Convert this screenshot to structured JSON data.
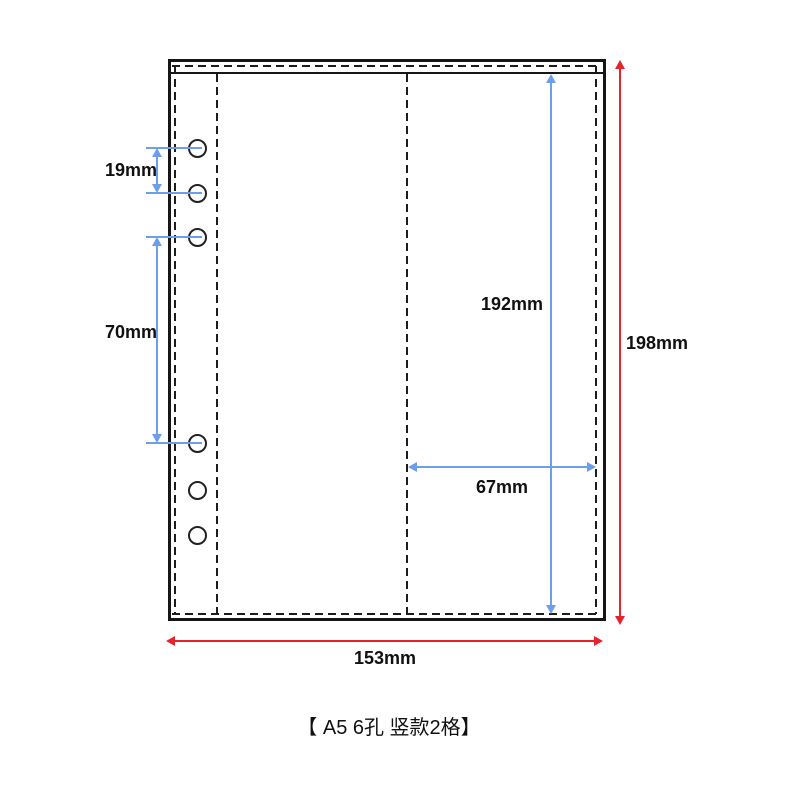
{
  "diagram": {
    "caption": "【 A5 6孔 竖款2格】",
    "dimensions": {
      "hole_spacing": "19mm",
      "hole_section_gap": "70mm",
      "inner_height": "192mm",
      "right_pocket_width": "67mm",
      "total_height": "198mm",
      "total_width": "153mm"
    },
    "holes_count": 6,
    "colors": {
      "outline": "#161616",
      "blue_dimension": "#6d9eeb",
      "red_dimension": "#e8222b"
    }
  }
}
